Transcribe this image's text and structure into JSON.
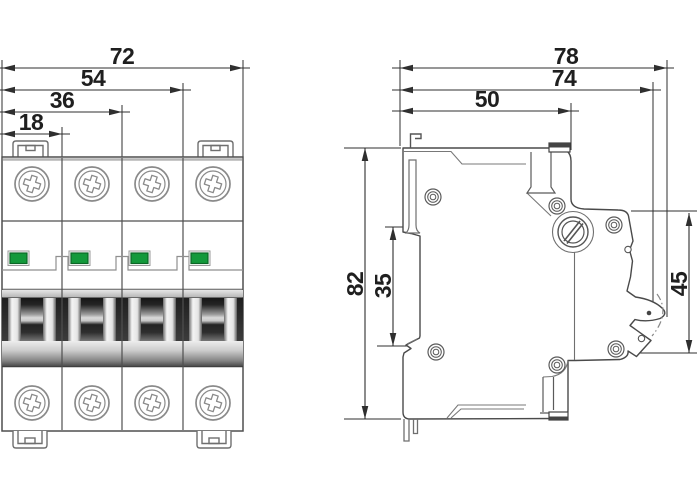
{
  "drawing": {
    "subject": "miniature-circuit-breaker-dimensional-drawing",
    "front_view": {
      "dim_total_width": "72",
      "dim_width_3_modules": "54",
      "dim_width_2_modules": "36",
      "dim_width_1_module": "18",
      "poles": 4
    },
    "side_view": {
      "dim_total_depth": "78",
      "dim_depth_to_toggle": "74",
      "dim_top_depth": "50",
      "dim_total_height": "82",
      "dim_din_recess_height": "35",
      "dim_front_face_height": "45"
    },
    "colors": {
      "background": "#ffffff",
      "outline": "#4a4a4a",
      "dim_line": "#2f2f2f",
      "text": "#1f1f1f",
      "led_green": "#13993b"
    }
  }
}
